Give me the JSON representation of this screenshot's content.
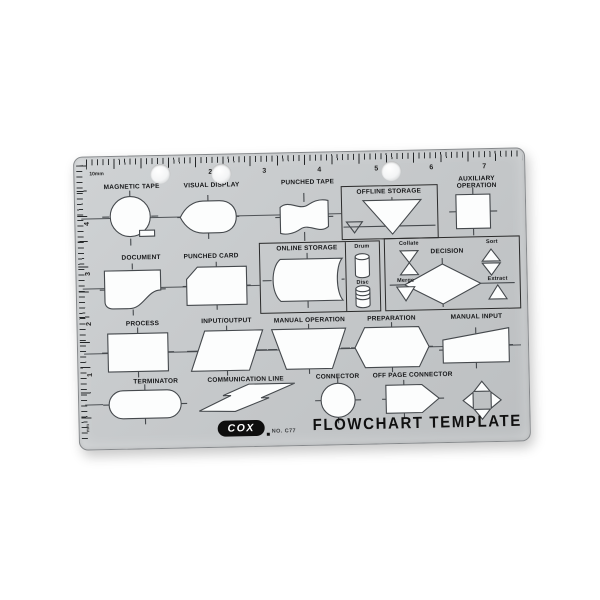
{
  "colors": {
    "template_gray": "#c6c9cb",
    "cutout_white": "#fcfdfd",
    "engrave_line": "#45494d",
    "text_black": "#17181a",
    "logo_black": "#0e0e0e"
  },
  "brand": {
    "logo": "COX",
    "model": "NO. C77",
    "title": "FLOWCHART TEMPLATE"
  },
  "icons": {
    "zero_arrow": "→"
  },
  "ruler": {
    "unit_label": "10mm",
    "side_unit": "mm",
    "top_numbers": [
      "1",
      "2",
      "3",
      "4",
      "5",
      "6",
      "7"
    ],
    "left_numbers": [
      "4",
      "3",
      "2",
      "1"
    ]
  },
  "labels": {
    "magnetic_tape": "MAGNETIC TAPE",
    "visual_display": "VISUAL DISPLAY",
    "punched_tape": "PUNCHED TAPE",
    "offline_storage": "OFFLINE STORAGE",
    "auxiliary_operation": "AUXILIARY OPERATION",
    "document": "DOCUMENT",
    "punched_card": "PUNCHED CARD",
    "online_storage": "ONLINE STORAGE",
    "drum": "Drum",
    "disc": "Disc",
    "collate": "Collate",
    "decision": "DECISION",
    "sort": "Sort",
    "merge": "Merge",
    "extract": "Extract",
    "process": "PROCESS",
    "input_output": "INPUT/OUTPUT",
    "manual_operation": "MANUAL OPERATION",
    "preparation": "PREPARATION",
    "manual_input": "MANUAL INPUT",
    "terminator": "TERMINATOR",
    "communication_line": "COMMUNICATION LINE",
    "connector": "CONNECTOR",
    "off_page_connector": "OFF PAGE CONNECTOR"
  }
}
